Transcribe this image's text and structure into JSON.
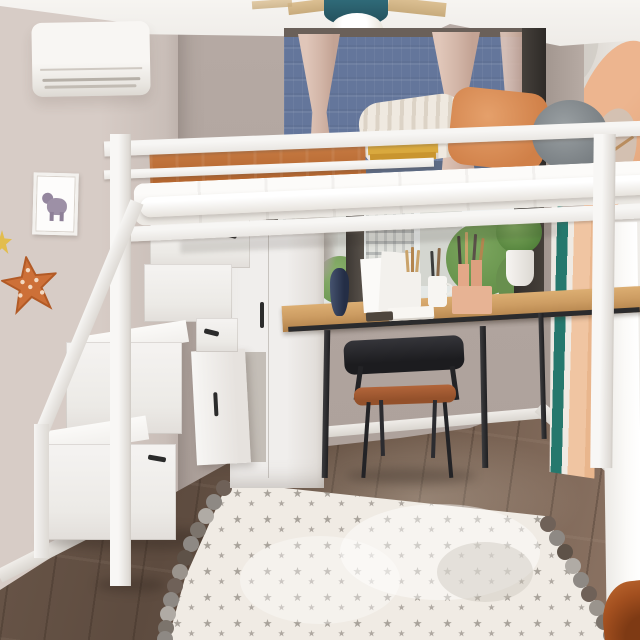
{
  "scene": {
    "type": "interior-photograph",
    "description": "Small bedroom with a white metal loft bed above a study nook: storage staircase with drawers, wood desk with stationery, black chair, two windows with city view, denim roman shade, star-pattern rug with pompoms",
    "objects": [
      "loft-bed",
      "guard-rail",
      "orange-blanket",
      "striped-pillow",
      "orange-pillow",
      "gray-bolster-cushion",
      "storage-staircase",
      "stair-drawers",
      "cabinet-open-door",
      "study-desk",
      "desk-chair",
      "navy-vase",
      "pencil-cups",
      "peach-organizers",
      "open-book",
      "upper-window",
      "roman-shade",
      "curtains",
      "lower-window",
      "window-sill",
      "pampas-grass",
      "topiary-plant",
      "air-conditioner",
      "ceiling-lamp",
      "elephant-wall-art",
      "orange-star-decor",
      "umbrella-wall-mural",
      "leaning-canvas",
      "star-pattern-rug",
      "pompom-fringe",
      "wood-floor",
      "rust-corner-object"
    ]
  },
  "palette": {
    "ceiling": "#f6f4f1",
    "wallLeft": "#d7ccc6",
    "wallBack": "#b0a49e",
    "wallRight": "#efede9",
    "floorDark": "#5d4b3f",
    "floorLight": "#8a7262",
    "bedFrame": "#f3f1ef",
    "blanket": "#b4662f",
    "pillowOrange": "#d08048",
    "bolsterGray": "#747a7e",
    "mattress": "#ece9e4",
    "bookYellow": "#d9a93e",
    "shadeDenim": "#64769b",
    "curtain": "#d2b5a7",
    "deskWood": "#cd9d63",
    "metalDark": "#2b2b2d",
    "seatBrown": "#94512b",
    "rugBase": "#f0ebe4",
    "rugStar": "#9b958d",
    "pomGray": "#8e8984",
    "pomTaupe": "#6f6158",
    "pomLight": "#b0aba5",
    "tealCanvas": "#25786d",
    "peachMural": "#edb58f",
    "starDecor": "#cd7038",
    "starYellow": "#e2bd4e",
    "topiary": "#51803a",
    "treeGreen": "#5d8a44",
    "lampTeal": "#2f6a78",
    "acWhite": "#f8f6f3",
    "rustObject": "#a24f1f"
  }
}
